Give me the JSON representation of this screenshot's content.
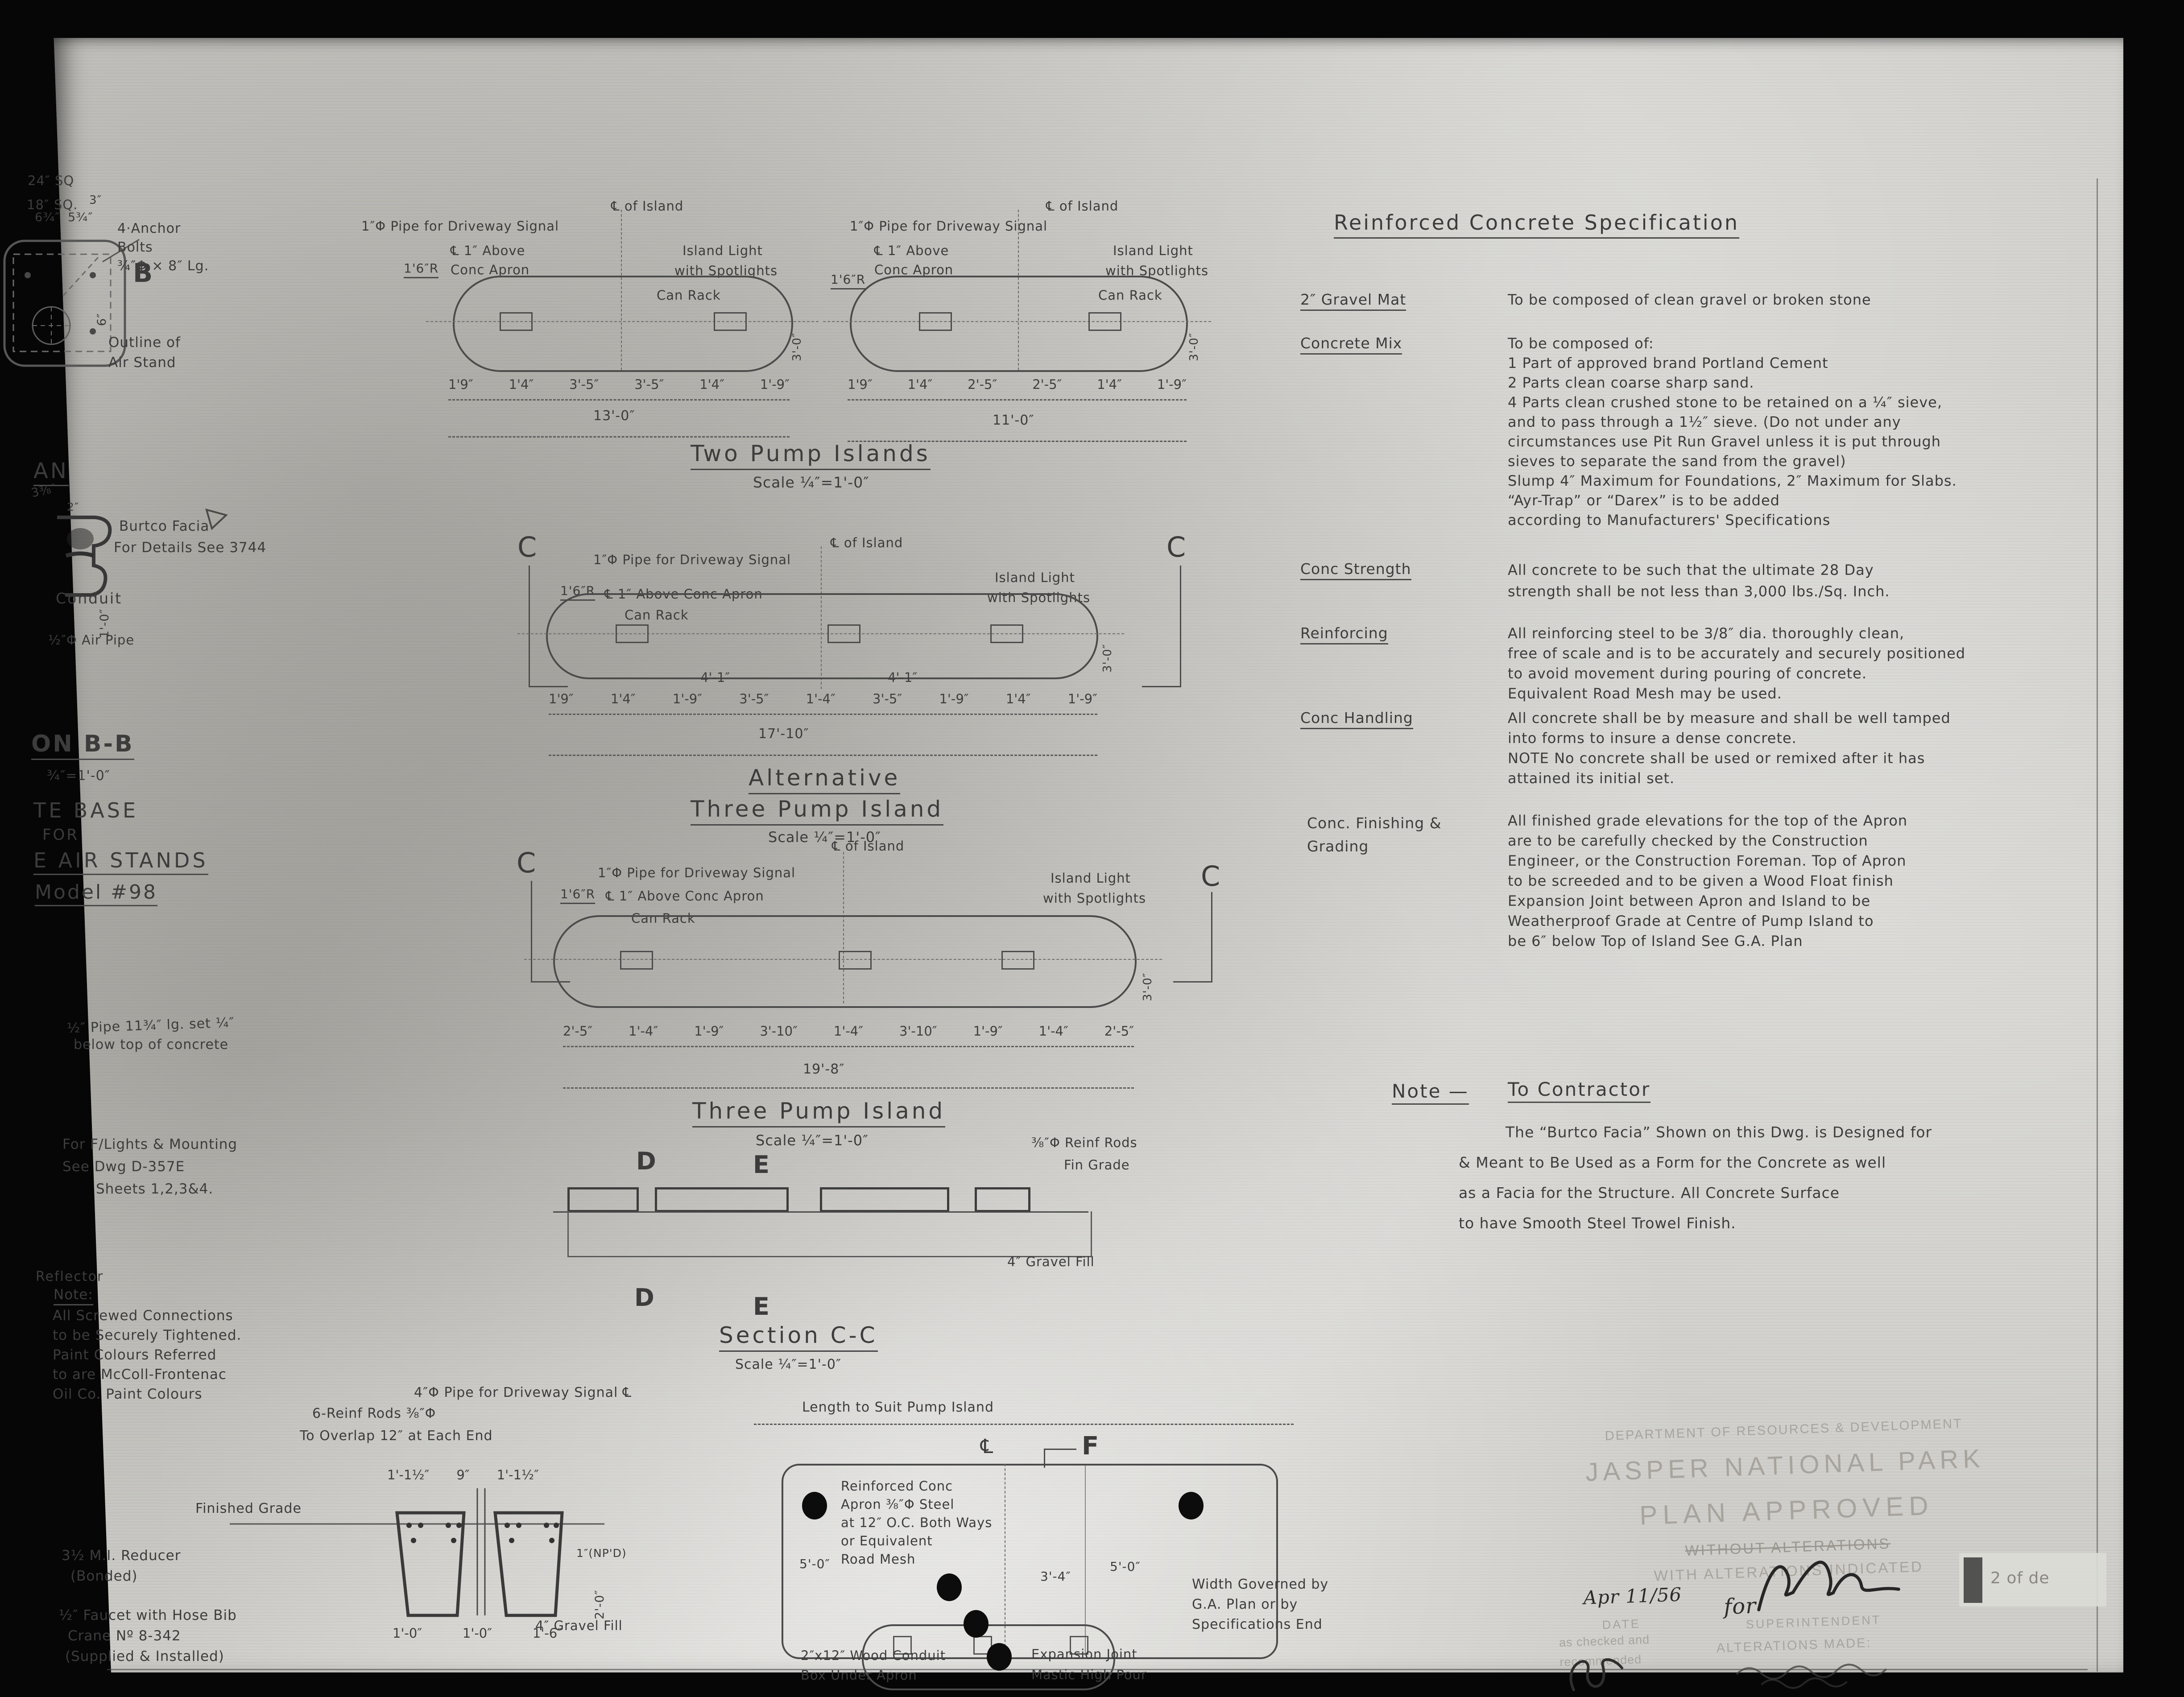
{
  "spec": {
    "heading": "Reinforced Concrete Specification",
    "items": [
      {
        "label": "2″ Gravel Mat",
        "lines": [
          "To be composed of clean gravel or broken stone"
        ]
      },
      {
        "label": "Concrete Mix",
        "lines": [
          "To be composed of:",
          "1 Part of approved brand Portland Cement",
          "2 Parts clean coarse sharp sand.",
          "4 Parts clean crushed stone to be retained on a ¼″ sieve,",
          "and to pass through a 1½″ sieve. (Do not under any",
          "circumstances use Pit Run Gravel unless it is put through",
          "sieves to separate the sand from the gravel)",
          "Slump 4″ Maximum for Foundations, 2″ Maximum for Slabs.",
          "“Ayr-Trap” or “Darex” is to be added",
          "according to Manufacturers' Specifications"
        ]
      },
      {
        "label": "Conc Strength",
        "lines": [
          "All concrete to be such that the ultimate 28 Day",
          "strength shall be not less than 3,000 lbs./Sq. Inch."
        ]
      },
      {
        "label": "Reinforcing",
        "lines": [
          "All reinforcing steel to be 3/8″ dia. thoroughly clean,",
          "free of scale and is to be accurately and securely positioned",
          "to avoid movement during pouring of concrete.",
          "Equivalent Road Mesh may be used."
        ]
      },
      {
        "label": "Conc Handling",
        "lines": [
          "All concrete shall be by measure and shall be well tamped",
          "into forms to insure a dense concrete.",
          "NOTE  No concrete shall be used or remixed after it has",
          "attained its initial set."
        ]
      },
      {
        "label": "Conc. Finishing & Grading",
        "lines": [
          "All finished grade elevations for the top of the Apron",
          "are to be carefully checked by the Construction",
          "Engineer, or the Construction Foreman. Top of Apron",
          "to be screeded and to be given a Wood Float finish",
          "Expansion Joint between Apron and Island to be",
          "Weatherproof  Grade at Centre of Pump Island to",
          "be 6″ below Top of Island   See G.A. Plan"
        ]
      }
    ]
  },
  "contractor_note": {
    "label": "Note —",
    "title": "To Contractor",
    "lines": [
      "The “Burtco Facia” Shown on this Dwg. is Designed for",
      "& Meant to Be Used as a Form for the Concrete as well",
      "as a Facia for the Structure. All Concrete Surface",
      "to have Smooth Steel Trowel Finish."
    ]
  },
  "two_pump": {
    "title": "Two Pump Islands",
    "scale": "Scale ¼″=1'-0″",
    "pipe_label": "1″Φ Pipe for Driveway Signal",
    "centerline_label": "℄ of Island",
    "apron_label_1": "℄ 1″ Above",
    "apron_label_2": "Conc Apron",
    "radius_label": "1'6″R",
    "light_label_1": "Island Light",
    "light_label_2": "with Spotlights",
    "can_rack": "Can Rack",
    "width_dim": "3'-0″",
    "island_a": {
      "dims": [
        "1'9″",
        "1'4″",
        "3'-5″",
        "3'-5″",
        "1'4″",
        "1'-9″"
      ],
      "total": "13'-0″"
    },
    "island_b": {
      "dims": [
        "1'9″",
        "1'4″",
        "2'-5″",
        "2'-5″",
        "1'4″",
        "1'-9″"
      ],
      "total": "11'-0″"
    }
  },
  "alt_three": {
    "title_line_1": "Alternative",
    "title_line_2": "Three Pump Island",
    "scale": "Scale ¼″=1'-0″",
    "section_letter": "C",
    "pipe_label": "1″Φ Pipe for Driveway Signal",
    "centerline_label": "℄ of Island",
    "apron_label": "℄ 1″ Above Conc Apron",
    "radius_label": "1'6″R",
    "light_label_1": "Island Light",
    "light_label_2": "with Spotlights",
    "can_rack": "Can Rack",
    "width_dim": "3'-0″",
    "sub_dims": [
      "4'-1″",
      "4'-1″"
    ],
    "dims": [
      "1'9″",
      "1'4″",
      "1'-9″",
      "3'-5″",
      "1'-4″",
      "3'-5″",
      "1'-9″",
      "1'4″",
      "1'-9″"
    ],
    "total": "17'-10″"
  },
  "three_pump": {
    "title": "Three Pump Island",
    "scale": "Scale ¼″=1'-0″",
    "section_letter": "C",
    "pipe_label": "1″Φ Pipe for Driveway Signal",
    "centerline_label": "℄ of Island",
    "apron_label": "℄ 1″ Above Conc Apron",
    "radius_label": "1'6″R",
    "light_label_1": "Island Light",
    "light_label_2": "with Spotlights",
    "can_rack": "Can Rack",
    "width_dim": "3'-0″",
    "dims": [
      "2'-5″",
      "1'-4″",
      "1'-9″",
      "3'-10″",
      "1'-4″",
      "3'-10″",
      "1'-9″",
      "1'-4″",
      "2'-5″"
    ],
    "total": "19'-8″"
  },
  "section_cc": {
    "title": "Section C-C",
    "scale": "Scale ¼″=1'-0″",
    "mark_d": "D",
    "mark_e": "E",
    "reinf_label": "⅜″Φ Reinf Rods",
    "fin_grade": "Fin Grade",
    "gravel_label": "4″ Gravel Fill"
  },
  "air_stand": {
    "dim_24": "24″ SQ",
    "dim_18": "18″ SQ.",
    "dim_634": "6¾″",
    "dim_534": "5¾″",
    "dim_3": "3″",
    "anchor_lines": [
      "4·Anchor",
      "Bolts",
      "¾″Φ × 8″ Lg."
    ],
    "mark_b": "B",
    "dim_v6": "6″",
    "outline_1": "Outline of",
    "outline_2": "Air Stand",
    "plan_frag": "AN",
    "dim_338": "3⅜″",
    "dim_2": "2″",
    "facia_1": "Burtco Facia",
    "facia_2": "For Details See  3744",
    "conduit": "Conduit",
    "air_pipe": "½″Φ Air Pipe",
    "dim_1ft": "1'-0″",
    "section_frag": "ON B-B",
    "scale_bb": "¾″=1'-0″",
    "base_frag_1": "TE  BASE",
    "base_frag_2": "FOR",
    "base_frag_3": "E AIR STANDS",
    "model": "Model #98"
  },
  "left_notes": {
    "pipe_1": "½″ Pipe 11¾″ lg. set ¼″",
    "pipe_2": "below top of concrete",
    "flights_1": "For F/Lights & Mounting",
    "flights_2": "See Dwg D-357E",
    "flights_3": "Sheets 1,2,3&4.",
    "reflector": "Reflector",
    "note_label": "Note:",
    "note_lines": [
      "All Screwed Connections",
      "to be Securely Tightened.",
      "Paint Colours Referred",
      "to are McColl-Frontenac",
      "Oil Co. Paint Colours"
    ]
  },
  "signal_detail": {
    "pipe_label": "4″Φ Pipe for Driveway Signal ℄",
    "reinf_1": "6-Reinf Rods ⅜″Φ",
    "reinf_2": "To Overlap 12″ at Each End",
    "dims_top": [
      "1'-1½″",
      "9″",
      "1'-1½″"
    ],
    "fin_grade": "Finished Grade",
    "reducer_1": "3½ M.I. Reducer",
    "reducer_2": "(Bonded)",
    "faucet_1": "½″ Faucet with Hose Bib",
    "faucet_2": "Crane Nº 8-342",
    "faucet_3": "(Supplied & Installed)",
    "dims_bottom": [
      "1'-0″",
      "1'-0″",
      "1'-6″"
    ],
    "npd": "1″(NP'D)",
    "vdim": "2'-0″",
    "gravel": "4″ Gravel Fill"
  },
  "apron_plan": {
    "length_note": "Length to Suit Pump Island",
    "cl": "℄",
    "mark_f": "F",
    "mesh_lines": [
      "Reinforced Conc",
      "Apron ⅜″Φ Steel",
      "at 12″ O.C. Both Ways",
      "or Equivalent",
      "Road Mesh"
    ],
    "dim_left": "5'-0″",
    "dim_right": "5'-0″",
    "dim_mid": "3'-4″",
    "width_lines": [
      "Width Governed by",
      "G.A. Plan or by",
      "Specifications End"
    ],
    "conduit_lines": [
      "2″x12″ Wood Conduit",
      "Box Under Apron"
    ],
    "expansion_lines": [
      "Expansion Joint",
      "Mastic High Pour"
    ]
  },
  "stamp": {
    "dept": "DEPARTMENT OF RESOURCES & DEVELOPMENT",
    "park": "JASPER NATIONAL PARK",
    "approved": "PLAN APPROVED",
    "without": "WITHOUT ALTERATIONS",
    "with_alt": "WITH ALTERATIONS INDICATED",
    "date_value": "Apr 11/56",
    "date_label": "DATE",
    "superintendent": "SUPERINTENDENT",
    "checked_1": "as checked and",
    "checked_2": "recommended",
    "alterations": "ALTERATIONS MADE:",
    "sig_for": "for",
    "file_note": "2 of de"
  }
}
